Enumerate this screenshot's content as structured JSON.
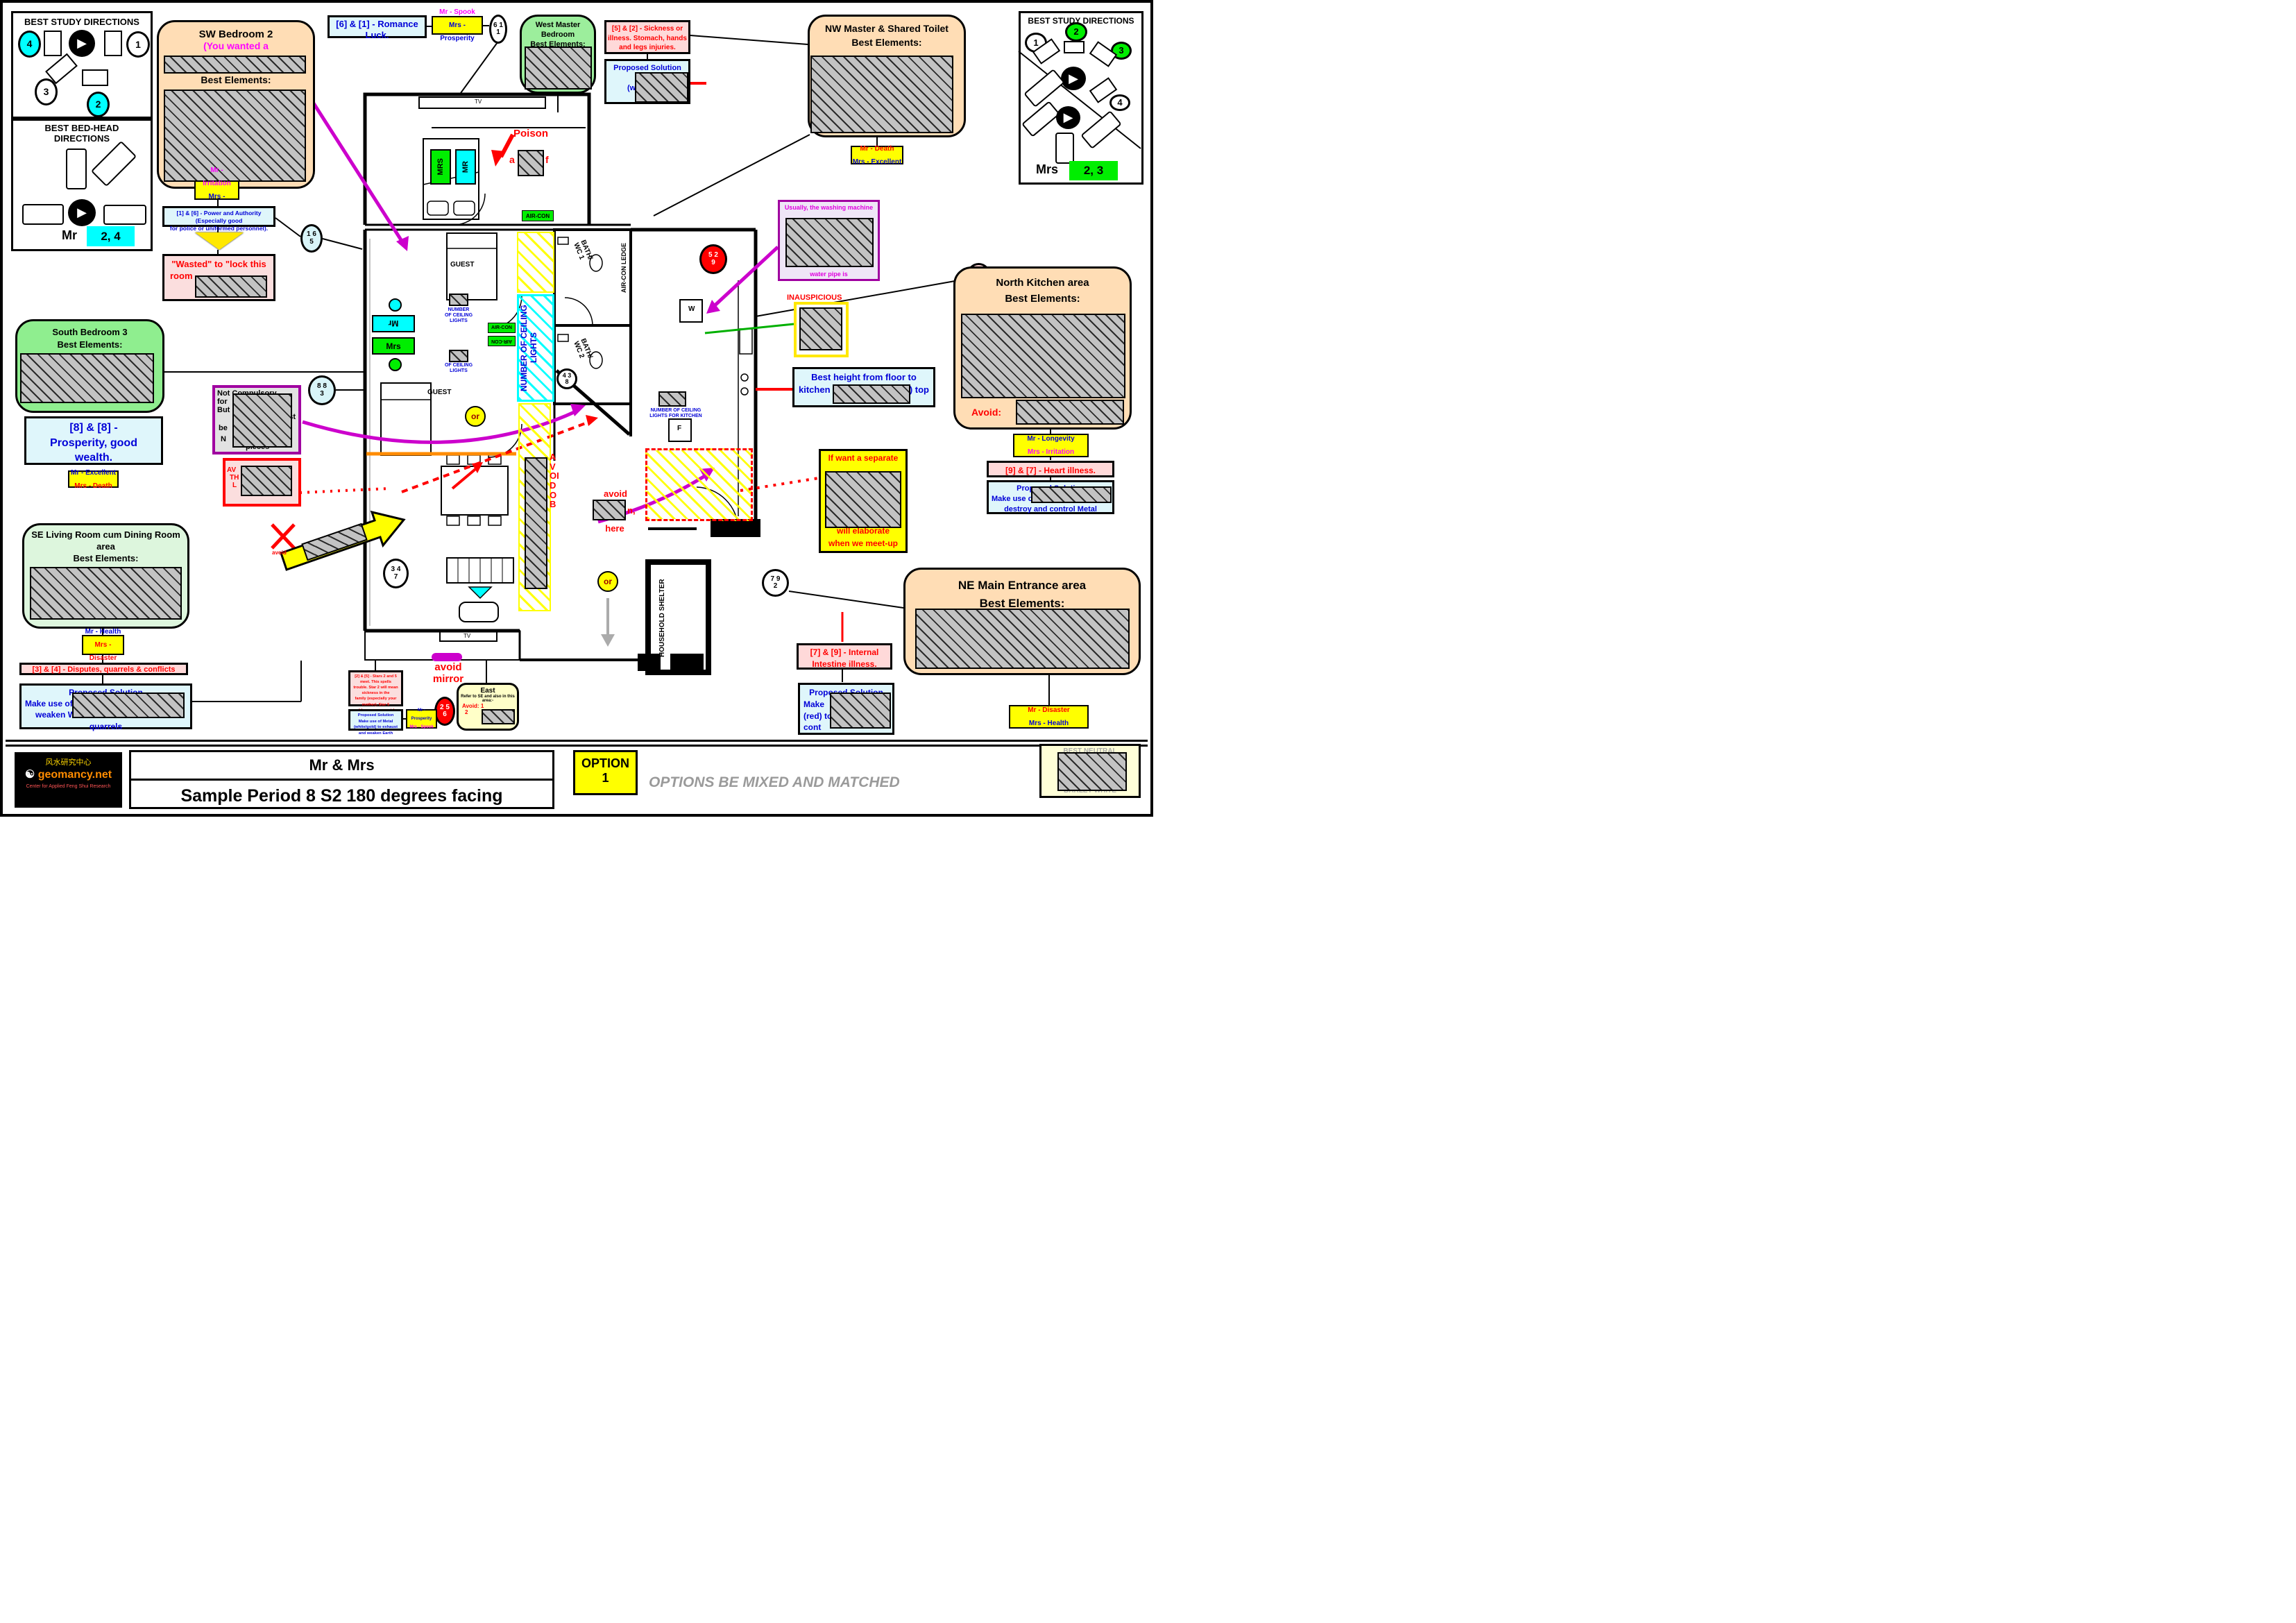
{
  "panels": {
    "study_left": {
      "title": "BEST STUDY DIRECTIONS",
      "n1": "1",
      "n2": "2",
      "n3": "3",
      "n4": "4"
    },
    "bedhead": {
      "t1": "BEST BED-HEAD",
      "t2": "DIRECTIONS",
      "person": "Mr",
      "best": "2, 4"
    },
    "study_right": {
      "title": "BEST STUDY DIRECTIONS",
      "n1": "1",
      "n2": "2",
      "n3": "3",
      "n4": "4",
      "person": "Mrs",
      "best": "2, 3"
    }
  },
  "boxes": {
    "sw_bedroom": {
      "title": "SW Bedroom 2",
      "note": "(You wanted a",
      "best": "Best Elements:"
    },
    "power": {
      "l1": "[1] & [6] - Power and Authority (Especially good",
      "l2": "for police or uniformed personnel)."
    },
    "wasted": {
      "l1": "\"Wasted\" to \"lock this",
      "l2": "room"
    },
    "romance": {
      "l1": "[6] & [1] - Romance",
      "l2": "Luck."
    },
    "west_master": {
      "t1": "West Master Bedroom",
      "t2": "Best Elements:"
    },
    "sickness": {
      "l1": "[5] & [2] - Sickness or",
      "l2": "illness. Stomach, hands",
      "l3": "and legs injuries."
    },
    "sickness_sol": {
      "t": "Proposed Solution",
      "l2": "Make",
      "l3": "(white/gol",
      "l4": "d",
      "l5": "we"
    },
    "nw_toilet": {
      "t1": "NW  Master & Shared Toilet",
      "t2": "Best Elements:"
    },
    "washing": {
      "l1": "Usually, the washing machine",
      "l2": "water pipe is"
    },
    "inauspicious": "INAUSPICIOUS",
    "kitchen": {
      "t1": "North Kitchen area",
      "t2": "Best Elements:",
      "avoid": "Avoid:"
    },
    "heart": "[9] & [7] - Heart illness.",
    "heart_sol": {
      "t": "Proposed Solution",
      "l2": "Make use of",
      "l3": "destroy and control Metal"
    },
    "height": {
      "l1": "Best height from floor to",
      "l2": "kitchen",
      "l3": "er) top"
    },
    "separate": {
      "l1": "If want a separate",
      "l2": "will elaborate",
      "l3": "when we meet-up"
    },
    "intestine": {
      "l1": "[7] & [9] - Internal",
      "l2": "Intestine illness."
    },
    "intestine_sol": {
      "t": "Proposed Solution",
      "l2": "Make",
      "l3": "(red) to",
      "l4": "cont"
    },
    "ne_entrance": {
      "t1": "NE Main Entrance area",
      "t2": "Best Elements:"
    },
    "south_bedroom": {
      "t1": "South Bedroom 3",
      "t2": "Best Elements:"
    },
    "prosperity": {
      "l1": "[8] & [8] -",
      "l2": "Prosperity, good",
      "l3": "wealth."
    },
    "not_compulsory": {
      "l1": "Not Compulsory",
      "l2": "for",
      "l3": "But",
      "l4": "st",
      "l5": "be",
      "l6": "N",
      "l7": "pieces"
    },
    "avoid_box": {
      "l1": "AV",
      "l2": "TH",
      "l3": "L"
    },
    "se_living": {
      "t1": "SE Living Room cum Dining Room",
      "t2": "area",
      "t3": "Best Elements:"
    },
    "disputes": "[3] & [4] - Disputes, quarrels & conflicts",
    "disputes_sol": {
      "t": "Proposed Solution",
      "l2": "Make use of",
      "l3": "weaken W",
      "l4": "quarrels"
    },
    "stars": {
      "l1": "[2] & [5] - Stars 2 and 5 meet. This spells",
      "l2": "trouble. Star 2 will mean sickness in the",
      "l3": "family (especially your mother). Star 5",
      "l4": "would mean some outdoor accident or",
      "l5": "troubles"
    },
    "stars_sol": {
      "t": "Proposed Solution",
      "l2": "Make use of Metal (white/gold) to exhaust",
      "l3": "and weaken Earth"
    },
    "east": {
      "t": "East",
      "l2": "Refer to SE and also in this area:-",
      "a1": "Avoid: 1",
      "a2": "2"
    }
  },
  "tags": {
    "sw": {
      "mr": "Mr - Irritation",
      "mrs": "Mrs - Longevity"
    },
    "romance": {
      "mr": "Mr - Spook",
      "mrs": "Mrs - Prosperity"
    },
    "nw": {
      "mr": "Mr - Death",
      "mrs": "Mrs - Excellent"
    },
    "south": {
      "mr": "Mr - Excellent",
      "mrs": "Mrs - Death"
    },
    "se": {
      "mr": "Mr - Health",
      "mrs": "Mrs - Disaster"
    },
    "stars": {
      "mr": "Mr - Prosperity",
      "mrs": "Mrs - Spook"
    },
    "kitchen": {
      "mr": "Mr - Longevity",
      "mrs": "Mrs - Irritation"
    },
    "ne": {
      "mr": "Mr - Disaster",
      "mrs": "Mrs - Health"
    }
  },
  "circles": {
    "c611": [
      "6 1",
      "1"
    ],
    "c165": [
      "1 6",
      "5"
    ],
    "c883": [
      "8 8",
      "3"
    ],
    "c438": [
      "4 3",
      "8"
    ],
    "c529": [
      "5 2",
      "9"
    ],
    "c974": [
      "9 7",
      "4"
    ],
    "c347": [
      "3 4",
      "7"
    ],
    "c792": [
      "7 9",
      "2"
    ],
    "c256": [
      "2 5",
      "6"
    ]
  },
  "plan": {
    "poison": "Poison",
    "poison_a": "a",
    "poison_f": "f",
    "avoid_mirror1": "avoid",
    "avoid_mirror2": "mirror",
    "avoid_here1": "avoid",
    "avoid_here_frag": "n,",
    "avoid_here2": "here",
    "avoid_ob": "AVOID OB",
    "guest": "GUEST",
    "mrs_bed": "MRS",
    "mr_bed": "MR",
    "mr_wall": "Mr",
    "mrs_wall": "Mrs",
    "aircon": "AIR-CON",
    "ledge": "AIR-CON LEDGE",
    "bath1": "BATH/ WC 1",
    "bath2": "BATH/ WC 2",
    "ncl_a1": "NUMBER",
    "ncl_a2": "OF CEILING",
    "ncl_a3": "LIGHTS",
    "ncl_b1": "OF CEILING",
    "ncl_b2": "LIGHTS",
    "ncl_corridor": "NUMBER OF CEILING LIGHTS",
    "ncl_k1": "NUMBER OF CEILING",
    "ncl_k2": "LIGHTS FOR KITCHEN",
    "shelter": "HOUSEHOLD SHELTER",
    "w": "W",
    "f": "F",
    "tv": "TV",
    "or": "or"
  },
  "footer": {
    "names": "Mr & Mrs",
    "subtitle": "Sample Period 8 S2 180 degrees facing",
    "option1": "OPTION",
    "option2": "1",
    "tagline": "OPTIONS BE MIXED AND MATCHED",
    "neutral1": "BEST NEUTRAL",
    "neutral2": "BARLEY WHITE",
    "logo_site": "geomancy.net",
    "logo_cn": "风水研究中心",
    "logo_sub": "Center for Applied Feng Shui Research"
  },
  "colors": {
    "accent_cyan": "#00ffff",
    "accent_green": "#00ee00",
    "tag_yellow": "#ffff00",
    "peach": "#ffddb5",
    "magenta": "#cc00cc"
  }
}
